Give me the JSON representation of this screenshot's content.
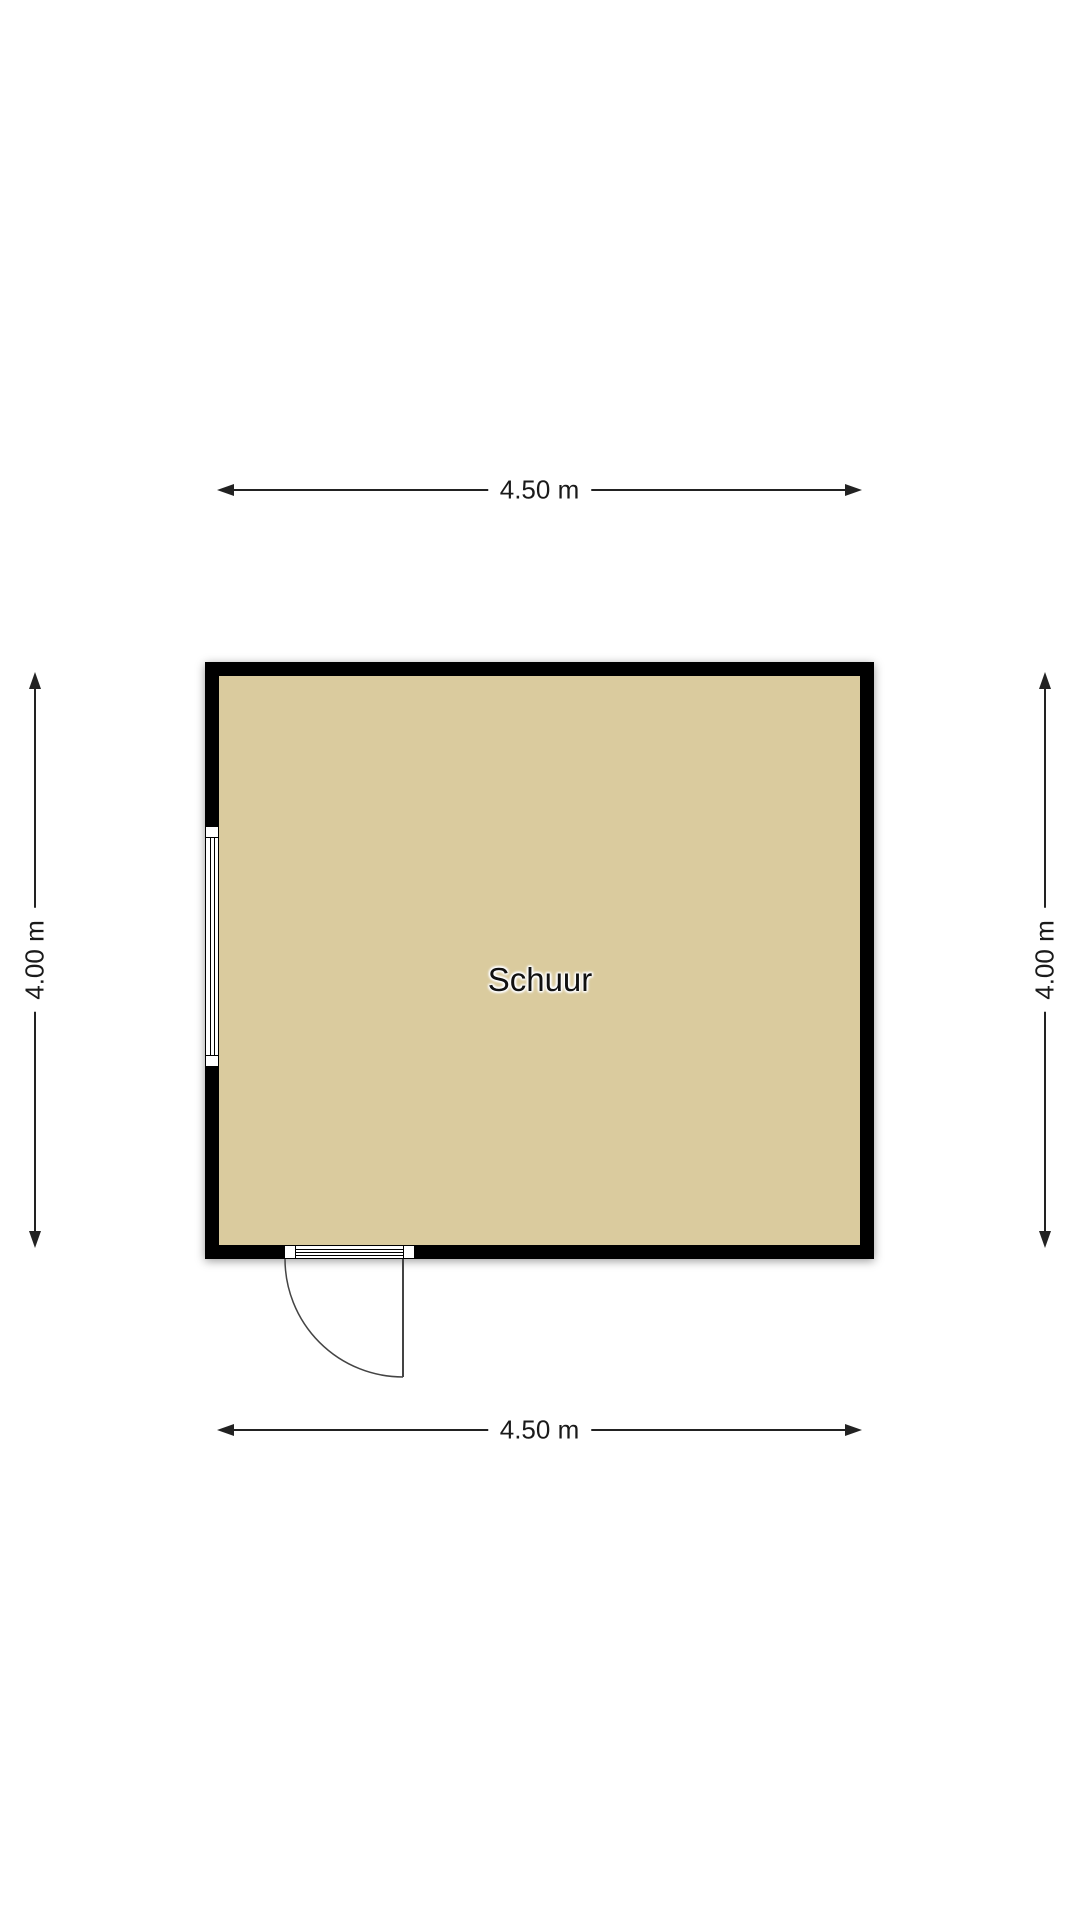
{
  "floorplan": {
    "room": {
      "label": "Schuur"
    },
    "dimensions": {
      "top": "4.50 m",
      "bottom": "4.50 m",
      "left": "4.00 m",
      "right": "4.00 m"
    },
    "colors": {
      "background": "#ffffff",
      "floor": "#dacb9e",
      "wall": "#000000",
      "line": "#222222",
      "door_stroke": "#444444",
      "label_text": "#111111"
    }
  }
}
